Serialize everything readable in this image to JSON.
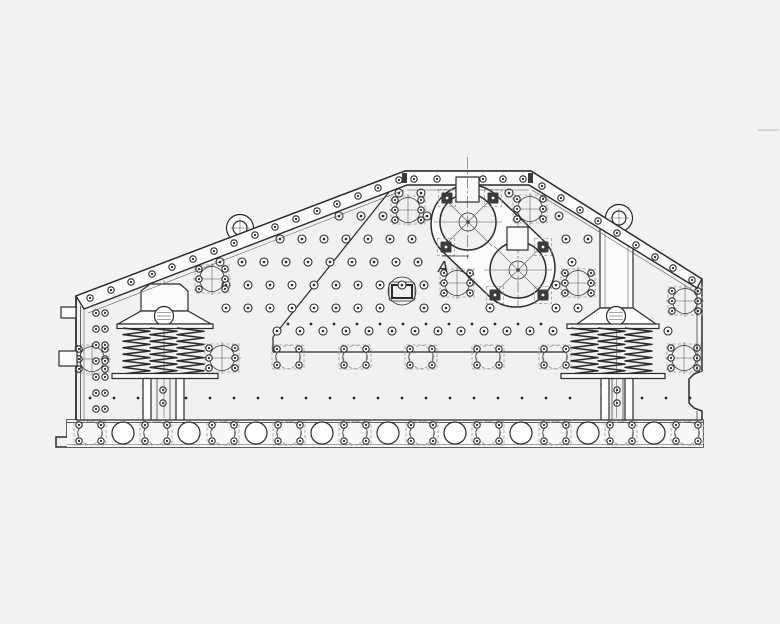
{
  "annotation": {
    "label": "A"
  },
  "page": {
    "width": 780,
    "height": 624,
    "background": "#f2f3f2"
  },
  "colors": {
    "page_bg": "#f2f3f2",
    "body": "#f1f1f1",
    "plate": "#fbfbfb",
    "rail": "#f8f8f8",
    "line": "#2b2b2b",
    "line_soft": "#555555",
    "dash": "#9b9b9b",
    "pad": "#3b3b3b",
    "white": "#ffffff",
    "tick": "#cfd3d6"
  }
}
